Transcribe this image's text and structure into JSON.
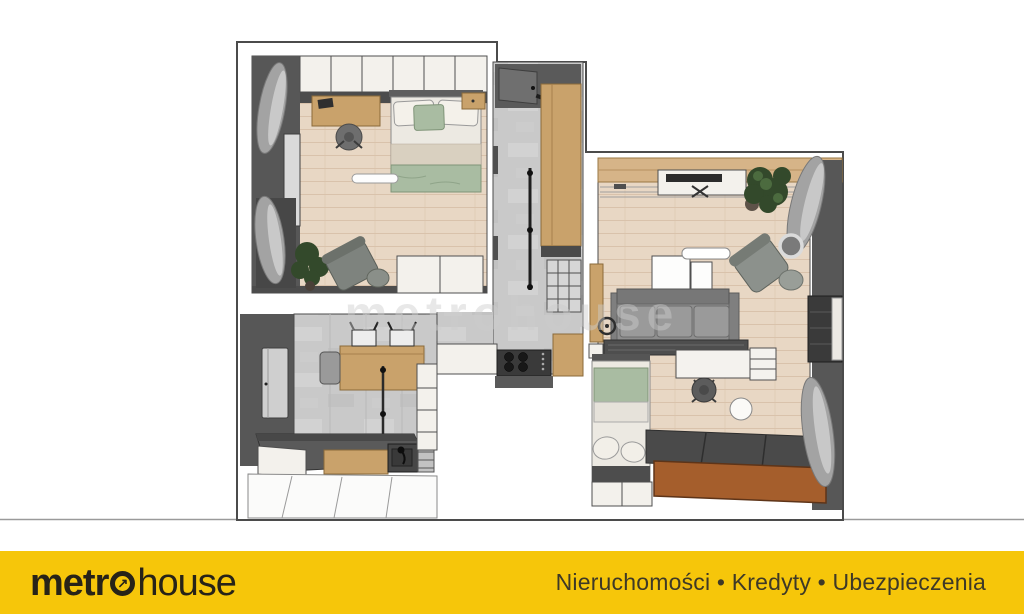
{
  "branding": {
    "logo_prefix": "metr",
    "logo_arrow": "↗",
    "logo_suffix": "house",
    "tagline": "Nieruchomości • Kredyty • Ubezpieczenia"
  },
  "watermark": {
    "text": "metrohouse"
  },
  "colors": {
    "bar_yellow": "#F6C60A",
    "logo_ink": "#272318",
    "tagline_ink": "#3E3927",
    "divider_gray": "#9A9A9A",
    "outline_gray": "#4B4B4B",
    "wall_dark": "#575757",
    "wood_floor": "#E8D7C4",
    "wood_floor_line": "#D9C2AB",
    "concrete_floor": "#C9C9C9",
    "white_unit": "#F3F1EC",
    "wood_furniture": "#C9A26B",
    "wood_beam": "#D6B488",
    "sofa_gray": "#8E8E8E",
    "sage_green": "#A9BCA2",
    "bed_white": "#ECE9E2",
    "plant_green": "#33492B",
    "platform_dark": "#4A4A4A",
    "platform_brown": "#A55E2C",
    "curtain_gray": "#A3A3A3"
  }
}
